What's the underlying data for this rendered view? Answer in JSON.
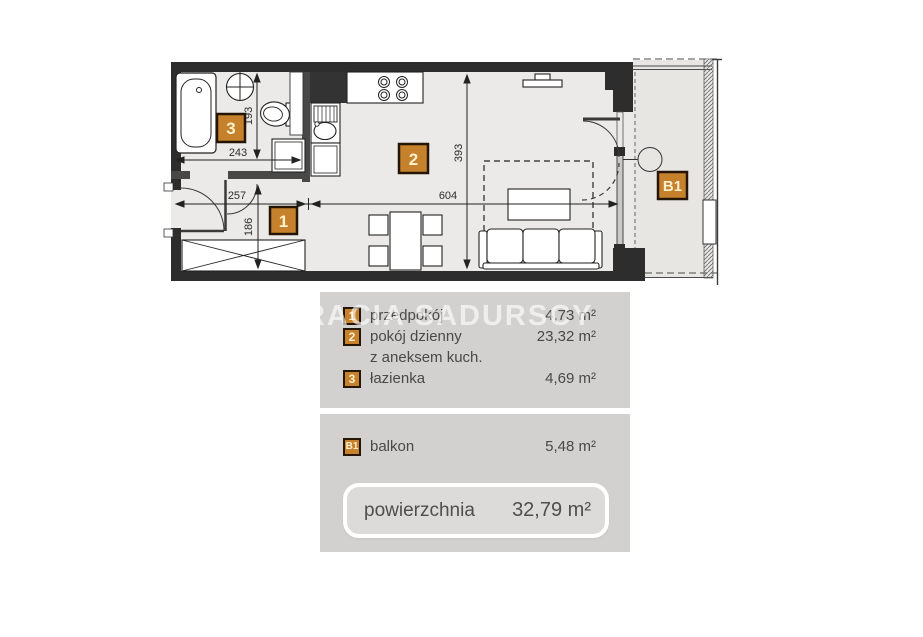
{
  "watermark": {
    "text": "BRACIA SADURSCY"
  },
  "plan": {
    "badges": {
      "hall": "1",
      "living": "2",
      "bath": "3",
      "balcony": "B1"
    },
    "dimensions": {
      "bath_width": "243",
      "bath_height": "193",
      "hall_width": "257",
      "hall_height": "186",
      "living_width": "604",
      "living_height": "393"
    }
  },
  "legend": {
    "rows": [
      {
        "badge": "1",
        "label": "przedpokój",
        "area": "4,73 m²"
      },
      {
        "badge": "2",
        "label": "pokój dzienny",
        "area": "23,32 m²"
      },
      {
        "badge": "",
        "label": "z aneksem kuch.",
        "area": ""
      },
      {
        "badge": "3",
        "label": "łazienka",
        "area": "4,69 m²"
      }
    ],
    "balcony_row": {
      "badge": "B1",
      "label": "balkon",
      "area": "5,48 m²"
    },
    "total": {
      "label": "powierzchnia",
      "area": "32,79 m²"
    }
  },
  "colors": {
    "wall": "#2d2d2d",
    "partition": "#484848",
    "floor": "#ebeae8",
    "balcony_floor": "#e7e6e3",
    "panel": "#d3d1cf",
    "total_box": "#dcdbd9",
    "badge": "#c5812c",
    "badge_border": "#241505",
    "text": "#4a4947"
  }
}
